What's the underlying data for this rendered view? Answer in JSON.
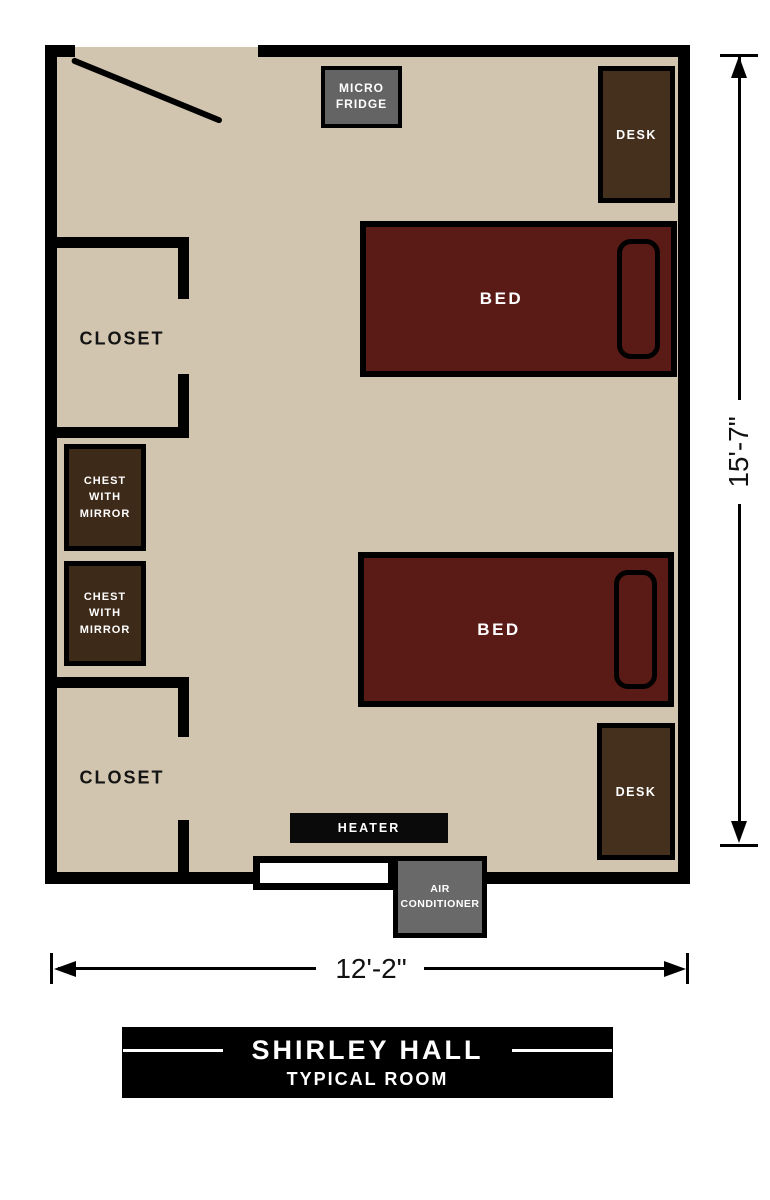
{
  "colors": {
    "floor": "#d1c5af",
    "wall": "#000000",
    "bed": "#5a1b17",
    "desk": "#45301e",
    "chest": "#3e2a19",
    "fridge": "#646464",
    "heater": "#0a0a0a",
    "ac": "#696969",
    "window": "#ffffff",
    "title_bg": "#000000"
  },
  "room": {
    "furniture": {
      "micro_fridge": {
        "label": "MICRO FRIDGE"
      },
      "desk_top": {
        "label": "DESK"
      },
      "bed_top": {
        "label": "BED"
      },
      "closet_top": {
        "label": "CLOSET"
      },
      "chest_upper": {
        "label": "CHEST WITH MIRROR"
      },
      "chest_lower": {
        "label": "CHEST WITH MIRROR"
      },
      "closet_bottom": {
        "label": "CLOSET"
      },
      "bed_bottom": {
        "label": "BED"
      },
      "desk_bottom": {
        "label": "DESK"
      },
      "heater": {
        "label": "HEATER"
      },
      "air_conditioner": {
        "label": "AIR CONDITIONER"
      }
    }
  },
  "dimensions": {
    "height_label": "15'-7\"",
    "width_label": "12'-2\""
  },
  "title_block": {
    "hall_name": "SHIRLEY HALL",
    "subtitle": "TYPICAL ROOM"
  }
}
